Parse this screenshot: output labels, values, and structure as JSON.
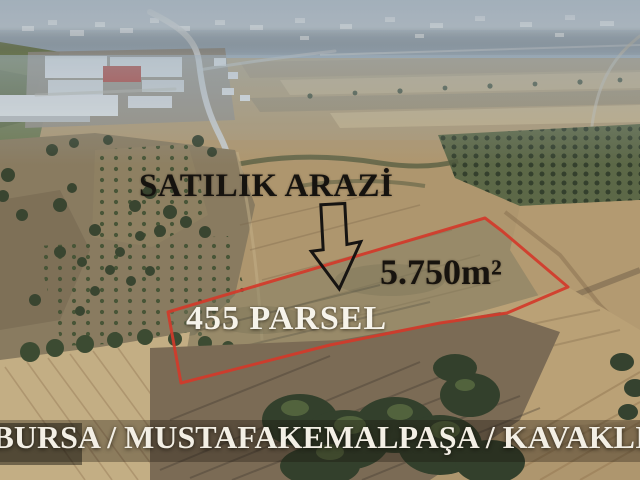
{
  "overlay": {
    "title": "SATILIK ARAZİ",
    "area": "5.750m²",
    "parcel_label": "455 PARSEL",
    "location_banner": "BURSA / MUSTAFAKEMALPAŞA / KAVAKLI",
    "arrow_direction": "down"
  },
  "colors": {
    "boundary_red": "#d23a2a",
    "arrow_outline": "#161412",
    "dark_text": "#16130f",
    "light_text": "#f3efe5",
    "banner_shade": "rgba(25,20,12,0.32)"
  },
  "icons": {
    "down_arrow": "⇩"
  }
}
